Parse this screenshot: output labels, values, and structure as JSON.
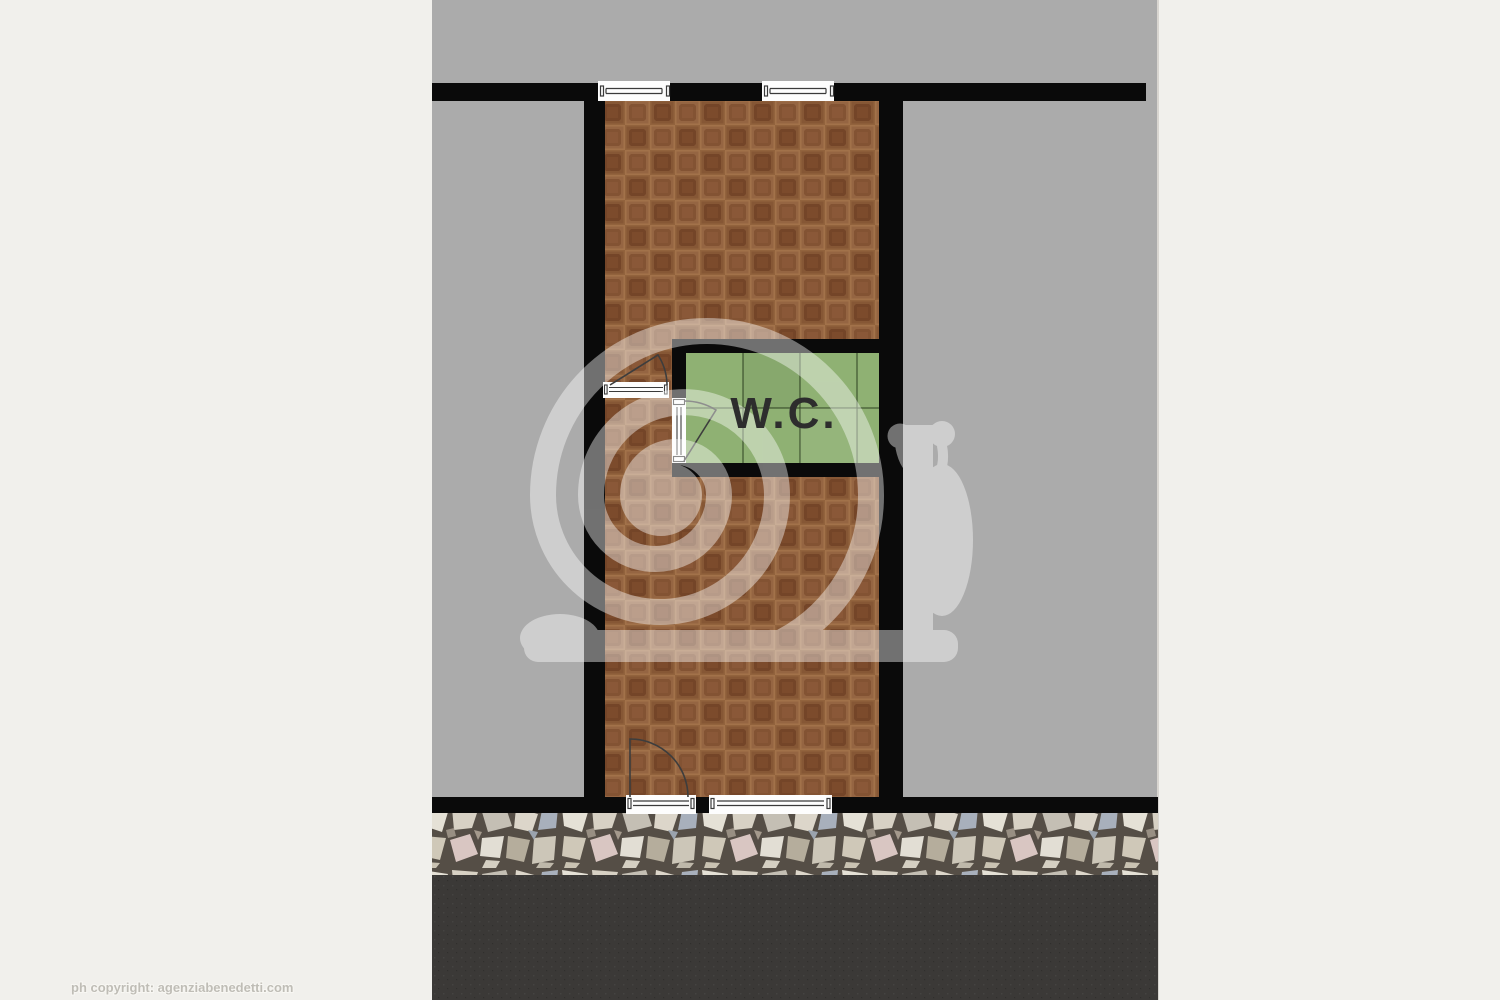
{
  "plan": {
    "wc_label": "W.C."
  },
  "footer": {
    "copyright_text": "ph copyright: agenziabenedetti.com"
  },
  "watermark": {
    "shape": "snail"
  },
  "colors": {
    "page_background": "#f1f0ec",
    "plan_background": "#ababab",
    "wall": "#0a0a0a",
    "parquet_base": "#8e5d3a",
    "wc_floor_green": "#8fb173",
    "wc_label_color": "#2d2d2d",
    "stone_grout": "#554e46",
    "asphalt": "#3b3937",
    "watermark": "#ffffff",
    "door_symbol": "#3d3d3d",
    "window_fill": "#fdfdfd",
    "copyright_color": "#bfbdb6",
    "margin_divider": "#d8d5d0"
  }
}
